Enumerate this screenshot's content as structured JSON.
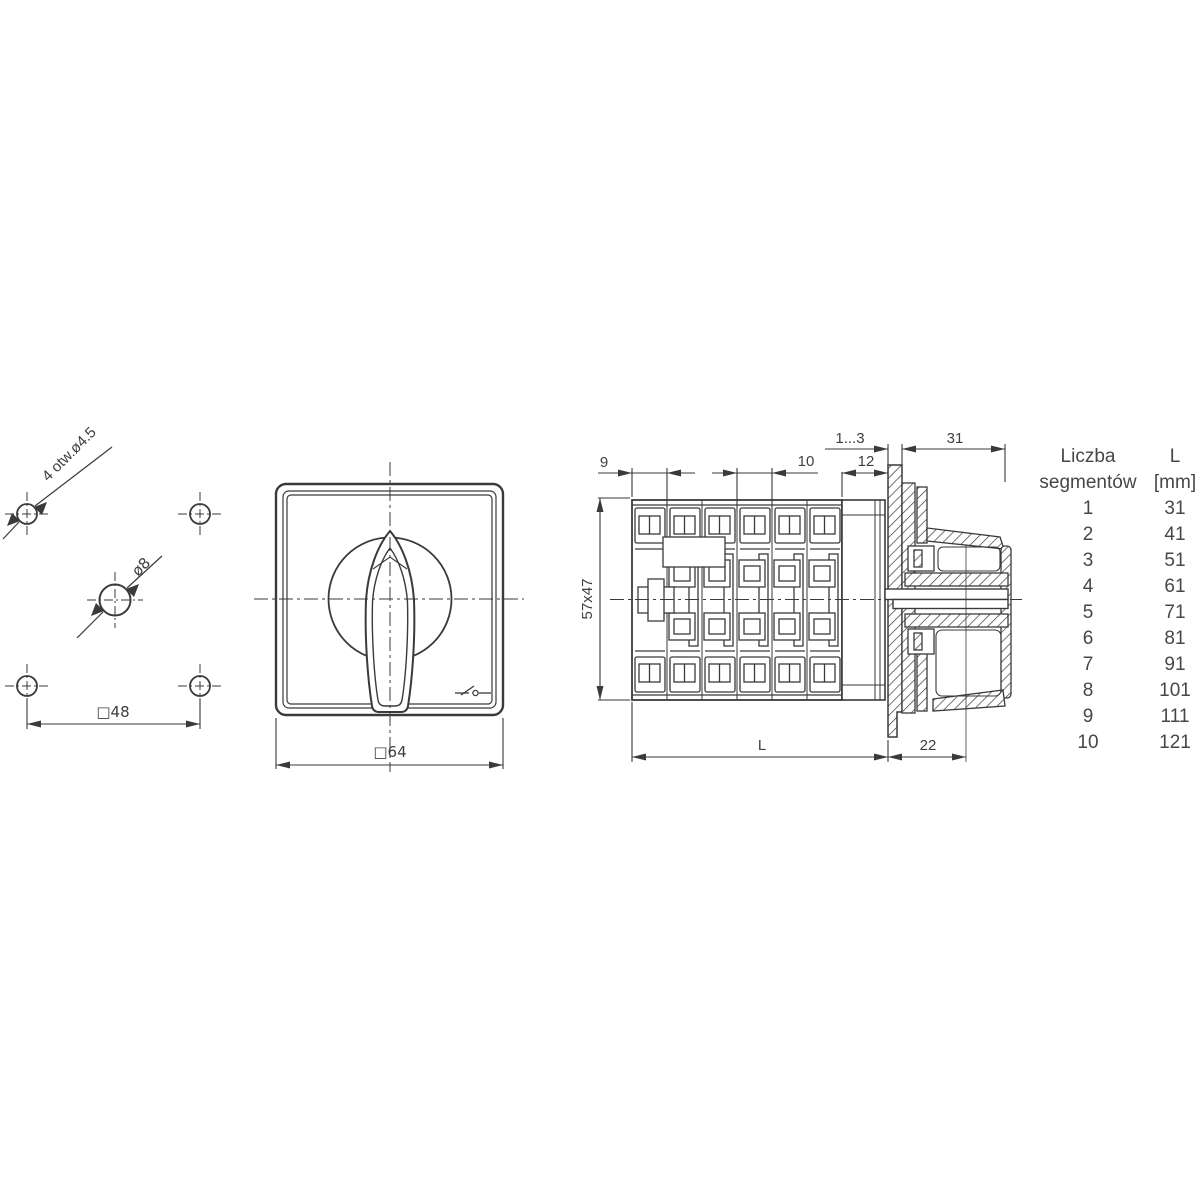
{
  "colors": {
    "line": "#3a3a3a",
    "text": "#3f3f3f"
  },
  "drilling_template": {
    "corner_holes_label": "4 otw.ø4.5",
    "center_hole_label": "ø8",
    "hole_spacing_label": "□48"
  },
  "front_view": {
    "width_label": "□64"
  },
  "side_view": {
    "dim_first_segment": "9",
    "dim_segment_pitch": "10",
    "dim_rear_section": "12",
    "dim_panel_thickness": "1...3",
    "dim_front_depth": "31",
    "dim_body_cross_section": "57x47",
    "dim_body_length": "L",
    "dim_knob_depth": "22"
  },
  "segments_table": {
    "col_segments_header": [
      "Liczba",
      "segmentów"
    ],
    "col_length_header": [
      "L",
      "[mm]"
    ],
    "rows": [
      {
        "segments": "1",
        "length_mm": "31"
      },
      {
        "segments": "2",
        "length_mm": "41"
      },
      {
        "segments": "3",
        "length_mm": "51"
      },
      {
        "segments": "4",
        "length_mm": "61"
      },
      {
        "segments": "5",
        "length_mm": "71"
      },
      {
        "segments": "6",
        "length_mm": "81"
      },
      {
        "segments": "7",
        "length_mm": "91"
      },
      {
        "segments": "8",
        "length_mm": "101"
      },
      {
        "segments": "9",
        "length_mm": "111"
      },
      {
        "segments": "10",
        "length_mm": "121"
      }
    ]
  }
}
